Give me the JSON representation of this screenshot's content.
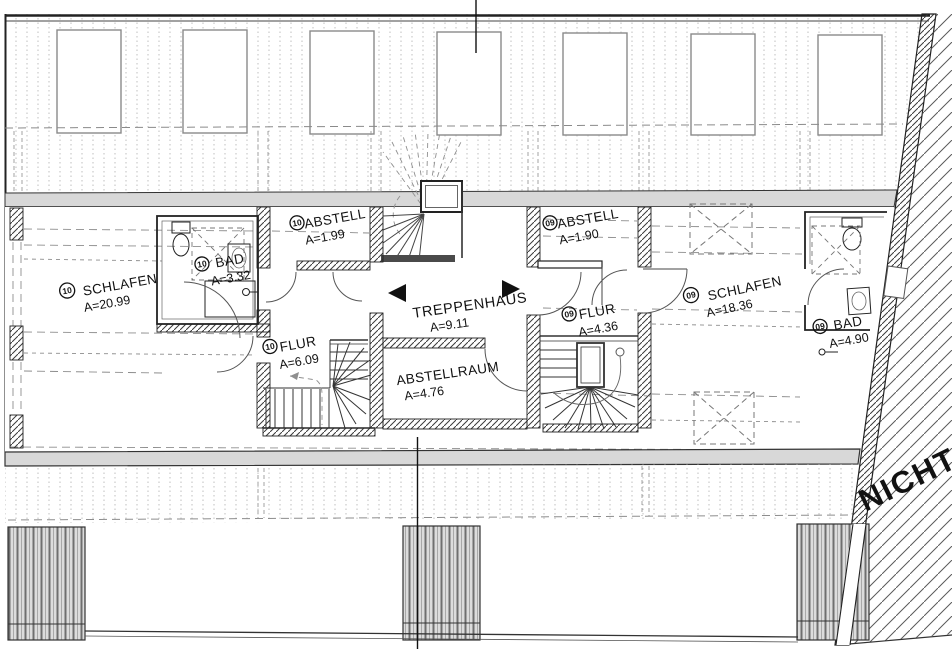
{
  "rooms": [
    {
      "id": "schlafen-10",
      "badge": "10",
      "name": "SCHLAFEN",
      "area": "A=20.99"
    },
    {
      "id": "bad-10",
      "badge": "10",
      "name": "BAD",
      "area": "A=3.32"
    },
    {
      "id": "abstell-10",
      "badge": "10",
      "name": "ABSTELL",
      "area": "A=1.99"
    },
    {
      "id": "flur-10",
      "badge": "10",
      "name": "FLUR",
      "area": "A=6.09"
    },
    {
      "id": "treppenhaus",
      "name": "TREPPENHAUS",
      "area": "A=9.11"
    },
    {
      "id": "abstellraum",
      "name": "ABSTELLRAUM",
      "area": "A=4.76"
    },
    {
      "id": "abstell-09",
      "badge": "09",
      "name": "ABSTELL",
      "area": "A=1.90"
    },
    {
      "id": "flur-09",
      "badge": "09",
      "name": "FLUR",
      "area": "A=4.36"
    },
    {
      "id": "schlafen-09",
      "badge": "09",
      "name": "SCHLAFEN",
      "area": "A=18.36"
    },
    {
      "id": "bad-09",
      "badge": "09",
      "name": "BAD",
      "area": "A=4.90"
    }
  ],
  "annotations": {
    "unfinished_area": "NICHT"
  },
  "colors": {
    "wall_line": "#222222",
    "band_fill": "#d8d8d8",
    "hatch": "#444444",
    "dash": "#888888"
  }
}
